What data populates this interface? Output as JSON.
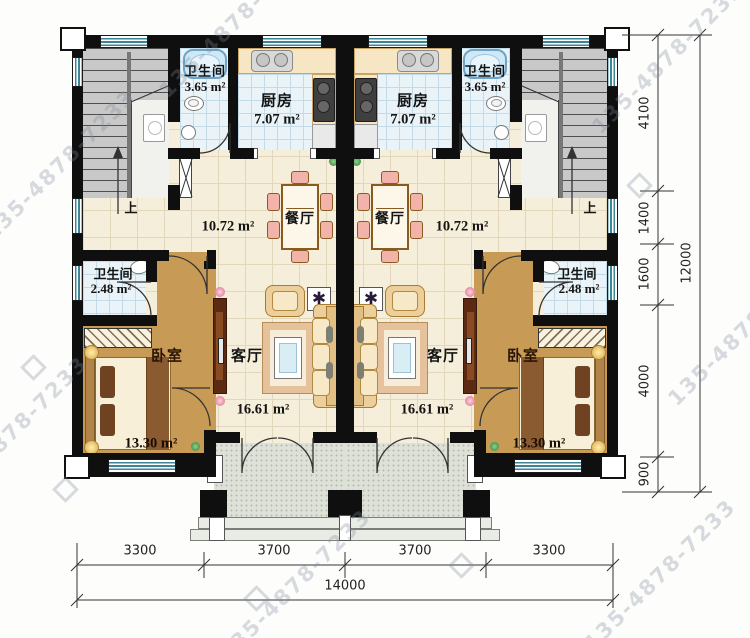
{
  "watermark": {
    "text": "135-4878-7233"
  },
  "stairs": {
    "up_label": "上"
  },
  "icons": {
    "plant_star": "✱",
    "flower": "✿"
  },
  "rooms": {
    "bath_top": {
      "name": "卫生间",
      "area": "3.65 m²"
    },
    "kitchen": {
      "name": "厨房",
      "area": "7.07 m²"
    },
    "dining": {
      "name": "餐厅",
      "area": "10.72 m²"
    },
    "bath_small": {
      "name": "卫生间",
      "area": "2.48 m²"
    },
    "bedroom": {
      "name": "卧室",
      "area": "13.30 m²"
    },
    "living": {
      "name": "客厅",
      "area": "16.61 m²"
    }
  },
  "dimensions": {
    "right": {
      "segments": [
        "4100",
        "1400",
        "1600",
        "4000",
        "900"
      ],
      "total": "12000"
    },
    "bottom": {
      "segments": [
        "3300",
        "3700",
        "3700",
        "3300"
      ],
      "total": "14000"
    }
  },
  "colors": {
    "wall": "#0f0f0f",
    "window": "#3d8494",
    "wood": "#c29150",
    "tile": "#f5eedb"
  }
}
